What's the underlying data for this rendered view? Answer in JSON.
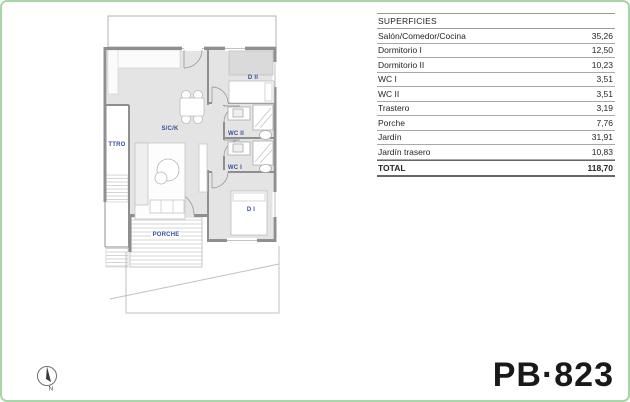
{
  "page": {
    "border_color": "#a6d7a6",
    "background": "#ffffff"
  },
  "plan": {
    "code": "PB·823",
    "label_color": "#34509e",
    "wall_color": "#8f8f8f",
    "room_fill": "#e4e4e4",
    "rooms": {
      "sck": "S/C/K",
      "ttro": "TTRO",
      "d2": "D II",
      "wc2": "WC II",
      "wc1": "WC I",
      "d1": "D I",
      "porche": "PORCHE"
    },
    "compass": {
      "letter": "N"
    }
  },
  "table": {
    "header": "SUPERFICIES",
    "rows": [
      {
        "label": "Salón/Comedor/Cocina",
        "value": "35,26"
      },
      {
        "label": "Dormitorio I",
        "value": "12,50"
      },
      {
        "label": "Dormitorio II",
        "value": "10,23"
      },
      {
        "label": "WC I",
        "value": "3,51"
      },
      {
        "label": "WC II",
        "value": "3,51"
      },
      {
        "label": "Trastero",
        "value": "3,19"
      },
      {
        "label": "Porche",
        "value": "7,76"
      },
      {
        "label": "Jardín",
        "value": "31,91"
      },
      {
        "label": "Jardín trasero",
        "value": "10,83"
      }
    ],
    "total": {
      "label": "TOTAL",
      "value": "118,70"
    }
  }
}
